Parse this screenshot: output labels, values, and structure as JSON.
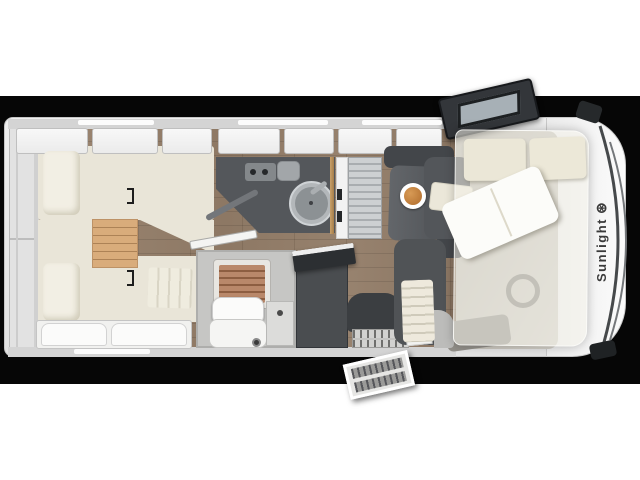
{
  "image": {
    "description": "Top-down floor plan of a Sunlight motorhome rendered on a black horizontal band",
    "background": "#ffffff",
    "band_color": "#060606"
  },
  "brand": {
    "name": "Sunlight",
    "logo_glyph": "⊛"
  },
  "palette": {
    "vehicle_body": "#e9e9e9",
    "front_cap": "#f8f8f8",
    "wood_floor": "#95806b",
    "bed_cream": "#e9e5d8",
    "pillow_cream": "#f2efe4",
    "oak_step": "#d9ac7b",
    "counter_dark": "#54575b",
    "bench_dark": "#43464a",
    "wardrobe_dark": "#4a4d50",
    "seat_gray": "#53565a",
    "shower_teak": "#b9886a",
    "brass_rail": "#b78f58",
    "toilet_white": "#fbfbfa",
    "food_plate": "#c9823e",
    "cab_door_dark": "#33363a",
    "drop_down_bed_overlay": "rgba(244,242,234,0.55)"
  },
  "objects": [
    "rear-storage-compartment",
    "twin-bed-upper",
    "twin-bed-lower",
    "bed-pillows",
    "bedroom-step",
    "overhead-cabinets",
    "kitchen-counter",
    "round-sink",
    "stove-burners",
    "fridge-tower",
    "dinette-table",
    "plate-of-food",
    "dinette-benches",
    "bathroom",
    "shower-teak-grate",
    "cassette-toilet",
    "vanity",
    "wardrobe-open-lid",
    "entry-seat",
    "entry-steps",
    "exterior-step",
    "cab-driver-seat",
    "cab-passenger-seat",
    "steering-wheel",
    "drop-down-bed",
    "open-cab-door",
    "windshield",
    "side-mirrors",
    "sunlight-wordmark"
  ]
}
